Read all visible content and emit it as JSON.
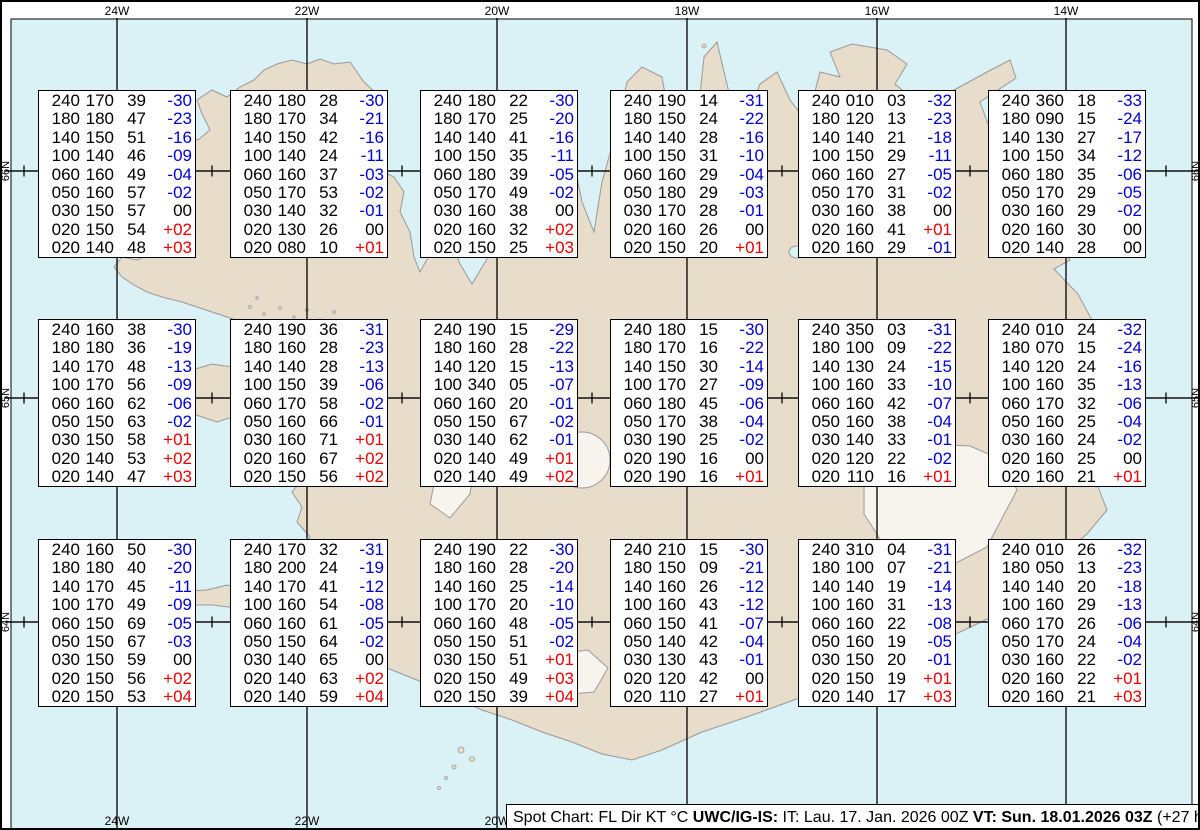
{
  "colors": {
    "ocean": "#daf1f6",
    "land": "#e8dccb",
    "coastline": "#999999",
    "glacier": "#f7f4ee",
    "grid": "#111111",
    "temp_negative": "#0000cd",
    "temp_positive": "#e60000",
    "text": "#000000"
  },
  "map": {
    "meridians": [
      {
        "label": "24W",
        "x": 115
      },
      {
        "label": "22W",
        "x": 305
      },
      {
        "label": "20W",
        "x": 495
      },
      {
        "label": "18W",
        "x": 685
      },
      {
        "label": "16W",
        "x": 875
      },
      {
        "label": "14W",
        "x": 1064
      }
    ],
    "parallels": [
      {
        "label": "66N",
        "y": 169
      },
      {
        "label": "65N",
        "y": 396
      },
      {
        "label": "64N",
        "y": 620
      }
    ],
    "cross_xs": [
      22,
      210,
      400,
      590,
      780,
      968,
      1164
    ]
  },
  "spot_boxes": [
    {
      "rows": [
        [
          "240",
          "170",
          "39",
          "-30"
        ],
        [
          "180",
          "180",
          "47",
          "-23"
        ],
        [
          "140",
          "150",
          "51",
          "-16"
        ],
        [
          "100",
          "140",
          "46",
          "-09"
        ],
        [
          "060",
          "160",
          "49",
          "-04"
        ],
        [
          "050",
          "160",
          "57",
          "-02"
        ],
        [
          "030",
          "150",
          "57",
          "00"
        ],
        [
          "020",
          "150",
          "54",
          "+02"
        ],
        [
          "020",
          "140",
          "48",
          "+03"
        ]
      ]
    },
    {
      "rows": [
        [
          "240",
          "180",
          "28",
          "-30"
        ],
        [
          "180",
          "170",
          "34",
          "-21"
        ],
        [
          "140",
          "150",
          "42",
          "-16"
        ],
        [
          "100",
          "140",
          "24",
          "-11"
        ],
        [
          "060",
          "160",
          "37",
          "-03"
        ],
        [
          "050",
          "170",
          "53",
          "-02"
        ],
        [
          "030",
          "140",
          "32",
          "-01"
        ],
        [
          "020",
          "130",
          "26",
          "00"
        ],
        [
          "020",
          "080",
          "10",
          "+01"
        ]
      ]
    },
    {
      "rows": [
        [
          "240",
          "180",
          "22",
          "-30"
        ],
        [
          "180",
          "170",
          "25",
          "-20"
        ],
        [
          "140",
          "140",
          "41",
          "-16"
        ],
        [
          "100",
          "150",
          "35",
          "-11"
        ],
        [
          "060",
          "180",
          "39",
          "-05"
        ],
        [
          "050",
          "170",
          "49",
          "-02"
        ],
        [
          "030",
          "160",
          "38",
          "00"
        ],
        [
          "020",
          "160",
          "32",
          "+02"
        ],
        [
          "020",
          "150",
          "25",
          "+03"
        ]
      ]
    },
    {
      "rows": [
        [
          "240",
          "190",
          "14",
          "-31"
        ],
        [
          "180",
          "150",
          "24",
          "-22"
        ],
        [
          "140",
          "140",
          "28",
          "-16"
        ],
        [
          "100",
          "150",
          "31",
          "-10"
        ],
        [
          "060",
          "160",
          "29",
          "-04"
        ],
        [
          "050",
          "180",
          "29",
          "-03"
        ],
        [
          "030",
          "170",
          "28",
          "-01"
        ],
        [
          "020",
          "160",
          "26",
          "00"
        ],
        [
          "020",
          "150",
          "20",
          "+01"
        ]
      ]
    },
    {
      "rows": [
        [
          "240",
          "010",
          "03",
          "-32"
        ],
        [
          "180",
          "120",
          "13",
          "-23"
        ],
        [
          "140",
          "140",
          "21",
          "-18"
        ],
        [
          "100",
          "150",
          "29",
          "-11"
        ],
        [
          "060",
          "160",
          "27",
          "-05"
        ],
        [
          "050",
          "170",
          "31",
          "-02"
        ],
        [
          "030",
          "160",
          "38",
          "00"
        ],
        [
          "020",
          "160",
          "41",
          "+01"
        ],
        [
          "020",
          "160",
          "29",
          "-01"
        ]
      ]
    },
    {
      "rows": [
        [
          "240",
          "360",
          "18",
          "-33"
        ],
        [
          "180",
          "090",
          "15",
          "-24"
        ],
        [
          "140",
          "130",
          "27",
          "-17"
        ],
        [
          "100",
          "150",
          "34",
          "-12"
        ],
        [
          "060",
          "180",
          "35",
          "-06"
        ],
        [
          "050",
          "170",
          "29",
          "-05"
        ],
        [
          "030",
          "160",
          "29",
          "-02"
        ],
        [
          "020",
          "160",
          "30",
          "00"
        ],
        [
          "020",
          "140",
          "28",
          "00"
        ]
      ]
    },
    {
      "rows": [
        [
          "240",
          "160",
          "38",
          "-30"
        ],
        [
          "180",
          "180",
          "36",
          "-19"
        ],
        [
          "140",
          "170",
          "48",
          "-13"
        ],
        [
          "100",
          "170",
          "56",
          "-09"
        ],
        [
          "060",
          "160",
          "62",
          "-06"
        ],
        [
          "050",
          "150",
          "63",
          "-02"
        ],
        [
          "030",
          "150",
          "58",
          "+01"
        ],
        [
          "020",
          "140",
          "53",
          "+02"
        ],
        [
          "020",
          "140",
          "47",
          "+03"
        ]
      ]
    },
    {
      "rows": [
        [
          "240",
          "190",
          "36",
          "-31"
        ],
        [
          "180",
          "160",
          "28",
          "-23"
        ],
        [
          "140",
          "140",
          "28",
          "-13"
        ],
        [
          "100",
          "150",
          "39",
          "-06"
        ],
        [
          "060",
          "170",
          "58",
          "-02"
        ],
        [
          "050",
          "160",
          "66",
          "-01"
        ],
        [
          "030",
          "160",
          "71",
          "+01"
        ],
        [
          "020",
          "160",
          "67",
          "+02"
        ],
        [
          "020",
          "150",
          "56",
          "+02"
        ]
      ]
    },
    {
      "rows": [
        [
          "240",
          "190",
          "15",
          "-29"
        ],
        [
          "180",
          "160",
          "28",
          "-22"
        ],
        [
          "140",
          "120",
          "15",
          "-13"
        ],
        [
          "100",
          "340",
          "05",
          "-07"
        ],
        [
          "060",
          "160",
          "20",
          "-01"
        ],
        [
          "050",
          "150",
          "67",
          "-02"
        ],
        [
          "030",
          "140",
          "62",
          "-01"
        ],
        [
          "020",
          "140",
          "49",
          "+01"
        ],
        [
          "020",
          "140",
          "49",
          "+02"
        ]
      ]
    },
    {
      "rows": [
        [
          "240",
          "180",
          "15",
          "-30"
        ],
        [
          "180",
          "170",
          "16",
          "-22"
        ],
        [
          "140",
          "150",
          "30",
          "-14"
        ],
        [
          "100",
          "170",
          "27",
          "-09"
        ],
        [
          "060",
          "180",
          "45",
          "-06"
        ],
        [
          "050",
          "170",
          "38",
          "-04"
        ],
        [
          "030",
          "190",
          "25",
          "-02"
        ],
        [
          "020",
          "190",
          "16",
          "00"
        ],
        [
          "020",
          "190",
          "16",
          "+01"
        ]
      ]
    },
    {
      "rows": [
        [
          "240",
          "350",
          "03",
          "-31"
        ],
        [
          "180",
          "100",
          "09",
          "-22"
        ],
        [
          "140",
          "130",
          "24",
          "-15"
        ],
        [
          "100",
          "160",
          "33",
          "-10"
        ],
        [
          "060",
          "160",
          "42",
          "-07"
        ],
        [
          "050",
          "160",
          "38",
          "-04"
        ],
        [
          "030",
          "140",
          "33",
          "-01"
        ],
        [
          "020",
          "120",
          "22",
          "-02"
        ],
        [
          "020",
          "110",
          "16",
          "+01"
        ]
      ]
    },
    {
      "rows": [
        [
          "240",
          "010",
          "24",
          "-32"
        ],
        [
          "180",
          "070",
          "15",
          "-24"
        ],
        [
          "140",
          "120",
          "24",
          "-16"
        ],
        [
          "100",
          "160",
          "35",
          "-13"
        ],
        [
          "060",
          "170",
          "32",
          "-06"
        ],
        [
          "050",
          "160",
          "25",
          "-04"
        ],
        [
          "030",
          "160",
          "24",
          "-02"
        ],
        [
          "020",
          "160",
          "25",
          "00"
        ],
        [
          "020",
          "160",
          "21",
          "+01"
        ]
      ]
    },
    {
      "rows": [
        [
          "240",
          "160",
          "50",
          "-30"
        ],
        [
          "180",
          "180",
          "40",
          "-20"
        ],
        [
          "140",
          "170",
          "45",
          "-11"
        ],
        [
          "100",
          "170",
          "49",
          "-09"
        ],
        [
          "060",
          "150",
          "69",
          "-05"
        ],
        [
          "050",
          "150",
          "67",
          "-03"
        ],
        [
          "030",
          "150",
          "59",
          "00"
        ],
        [
          "020",
          "150",
          "56",
          "+02"
        ],
        [
          "020",
          "150",
          "53",
          "+04"
        ]
      ]
    },
    {
      "rows": [
        [
          "240",
          "170",
          "32",
          "-31"
        ],
        [
          "180",
          "200",
          "24",
          "-19"
        ],
        [
          "140",
          "170",
          "41",
          "-12"
        ],
        [
          "100",
          "160",
          "54",
          "-08"
        ],
        [
          "060",
          "160",
          "61",
          "-05"
        ],
        [
          "050",
          "150",
          "64",
          "-02"
        ],
        [
          "030",
          "140",
          "65",
          "00"
        ],
        [
          "020",
          "140",
          "63",
          "+02"
        ],
        [
          "020",
          "140",
          "59",
          "+04"
        ]
      ]
    },
    {
      "rows": [
        [
          "240",
          "190",
          "22",
          "-30"
        ],
        [
          "180",
          "160",
          "28",
          "-20"
        ],
        [
          "140",
          "160",
          "25",
          "-14"
        ],
        [
          "100",
          "170",
          "20",
          "-10"
        ],
        [
          "060",
          "160",
          "48",
          "-05"
        ],
        [
          "050",
          "150",
          "51",
          "-02"
        ],
        [
          "030",
          "150",
          "51",
          "+01"
        ],
        [
          "020",
          "150",
          "49",
          "+03"
        ],
        [
          "020",
          "150",
          "39",
          "+04"
        ]
      ]
    },
    {
      "rows": [
        [
          "240",
          "210",
          "15",
          "-30"
        ],
        [
          "180",
          "150",
          "09",
          "-21"
        ],
        [
          "140",
          "160",
          "26",
          "-12"
        ],
        [
          "100",
          "160",
          "43",
          "-12"
        ],
        [
          "060",
          "150",
          "41",
          "-07"
        ],
        [
          "050",
          "140",
          "42",
          "-04"
        ],
        [
          "030",
          "130",
          "43",
          "-01"
        ],
        [
          "020",
          "120",
          "42",
          "00"
        ],
        [
          "020",
          "110",
          "27",
          "+01"
        ]
      ]
    },
    {
      "rows": [
        [
          "240",
          "310",
          "04",
          "-31"
        ],
        [
          "180",
          "100",
          "07",
          "-21"
        ],
        [
          "140",
          "140",
          "19",
          "-14"
        ],
        [
          "100",
          "160",
          "31",
          "-13"
        ],
        [
          "060",
          "160",
          "22",
          "-08"
        ],
        [
          "050",
          "160",
          "19",
          "-05"
        ],
        [
          "030",
          "150",
          "20",
          "-01"
        ],
        [
          "020",
          "150",
          "19",
          "+01"
        ],
        [
          "020",
          "140",
          "17",
          "+03"
        ]
      ]
    },
    {
      "rows": [
        [
          "240",
          "010",
          "26",
          "-32"
        ],
        [
          "180",
          "050",
          "13",
          "-23"
        ],
        [
          "140",
          "140",
          "20",
          "-18"
        ],
        [
          "100",
          "160",
          "29",
          "-13"
        ],
        [
          "060",
          "170",
          "26",
          "-06"
        ],
        [
          "050",
          "170",
          "24",
          "-04"
        ],
        [
          "030",
          "160",
          "22",
          "-02"
        ],
        [
          "020",
          "160",
          "22",
          "+01"
        ],
        [
          "020",
          "160",
          "21",
          "+03"
        ]
      ]
    }
  ],
  "status_bar": {
    "segments": [
      {
        "text": "Spot Chart: FL Dir KT °C ",
        "bold": false
      },
      {
        "text": "UWC/IG-IS:",
        "bold": true
      },
      {
        "text": " IT: Lau. 17. Jan. 2026 00Z ",
        "bold": false
      },
      {
        "text": "VT: Sun. 18.01.2026 03Z",
        "bold": true
      },
      {
        "text": " (+27 h)",
        "bold": false
      }
    ]
  }
}
